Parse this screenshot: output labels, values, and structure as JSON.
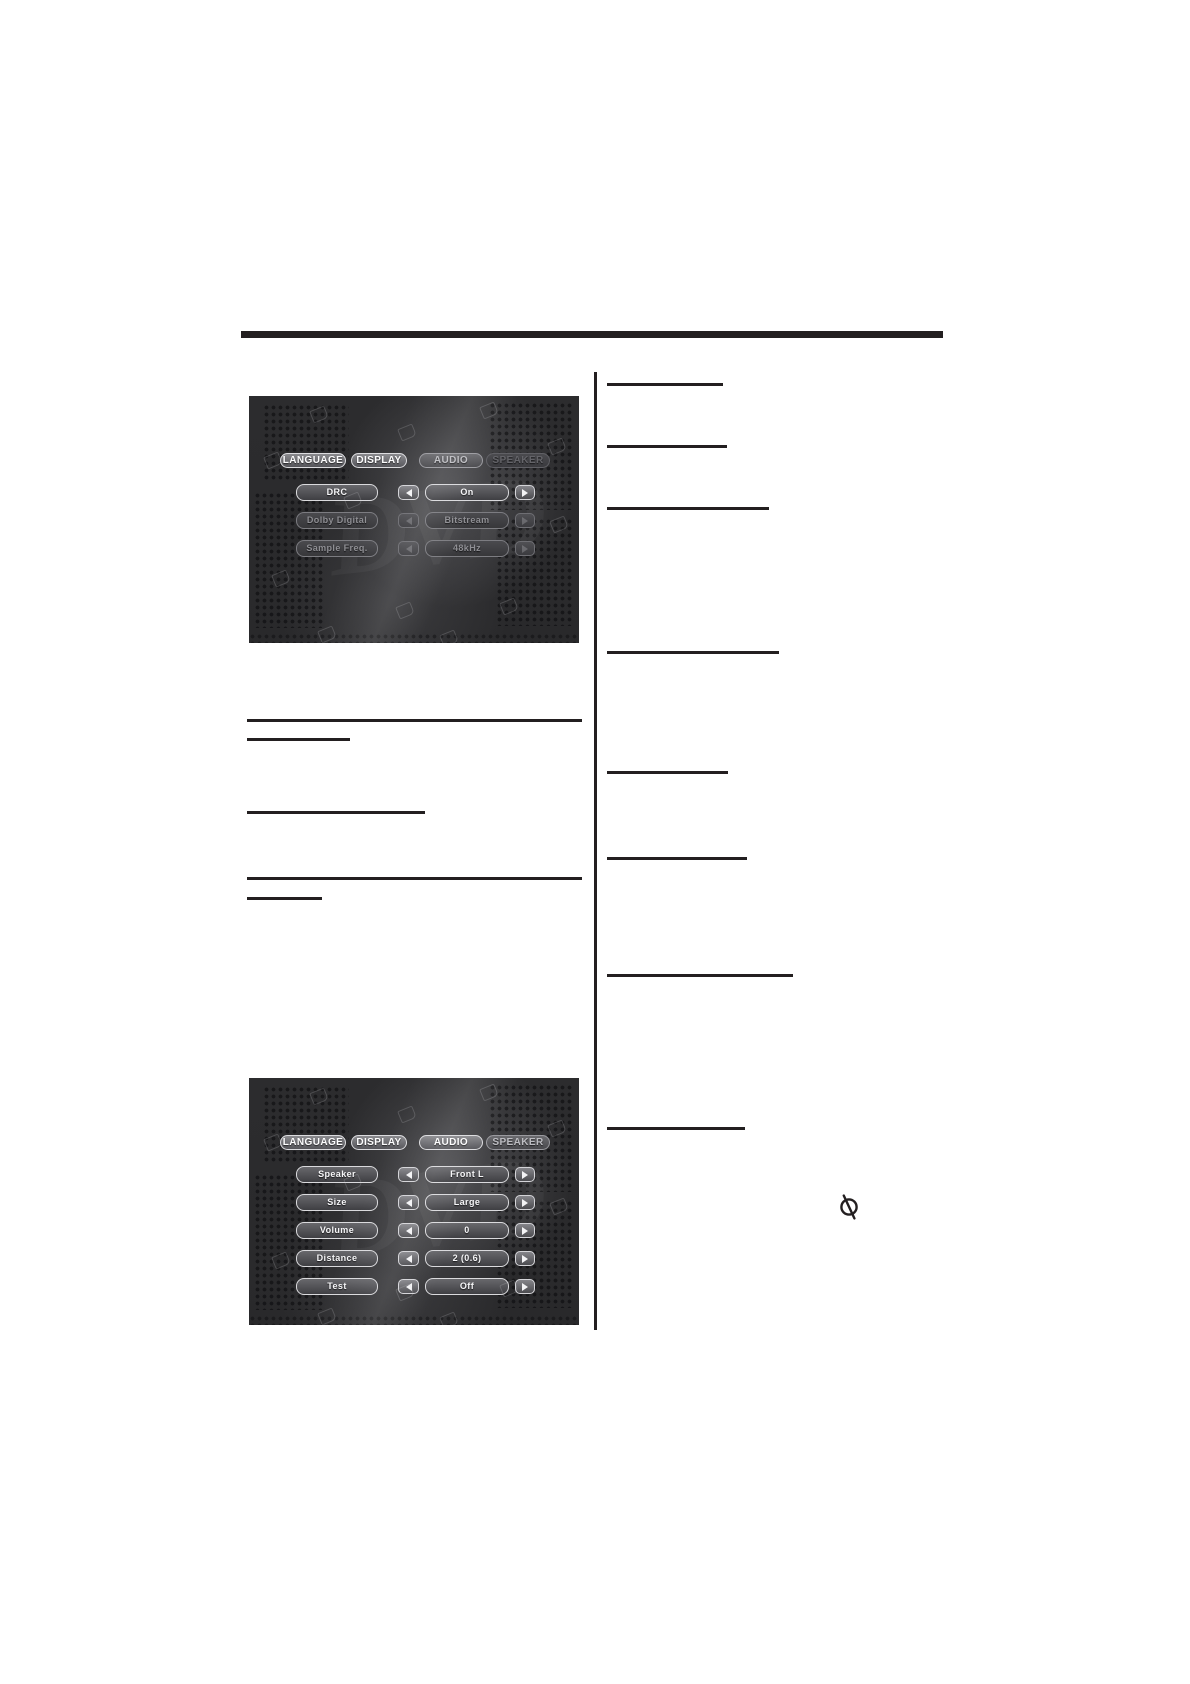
{
  "page": {
    "ink_color": "#231f20",
    "background_color": "#ffffff",
    "panel_background_color": "#2b2b2d",
    "osd_text_bright_color": "#f6f6f8",
    "osd_text_dim_color": "#8f8f94"
  },
  "osd_watermark": "DVD",
  "osd_screens": [
    {
      "name": "osd-screenshot-audio-settings",
      "tabs": [
        {
          "label": "LANGUAGE",
          "state": "bright"
        },
        {
          "label": "DISPLAY",
          "state": "bright"
        },
        {
          "label": "AUDIO",
          "state": "medium"
        },
        {
          "label": "SPEAKER",
          "state": "dim"
        }
      ],
      "rows": [
        {
          "label": "DRC",
          "value": "On",
          "state": "active"
        },
        {
          "label": "Dolby Digital",
          "value": "Bitstream",
          "state": "dim"
        },
        {
          "label": "Sample Freq.",
          "value": "48kHz",
          "state": "dim"
        }
      ]
    },
    {
      "name": "osd-screenshot-speaker-settings",
      "tabs": [
        {
          "label": "LANGUAGE",
          "state": "bright"
        },
        {
          "label": "DISPLAY",
          "state": "bright"
        },
        {
          "label": "AUDIO",
          "state": "bright"
        },
        {
          "label": "SPEAKER",
          "state": "medium"
        }
      ],
      "rows": [
        {
          "label": "Speaker",
          "value": "Front L",
          "state": "active"
        },
        {
          "label": "Size",
          "value": "Large",
          "state": "active"
        },
        {
          "label": "Volume",
          "value": "0",
          "state": "active"
        },
        {
          "label": "Distance",
          "value": "2 (0.6)",
          "state": "active"
        },
        {
          "label": "Test",
          "value": "Off",
          "state": "active"
        }
      ]
    }
  ],
  "print_marks": {
    "top_bar": {
      "name": "section-title-bar",
      "x": 241,
      "y": 331,
      "w": 702,
      "h": 7
    },
    "divider": {
      "name": "column-divider-line",
      "x": 594,
      "y": 372,
      "w": 2.5,
      "h": 958
    },
    "rules": [
      {
        "name": "left-column-rule-1",
        "x": 247,
        "y": 719,
        "w": 335,
        "h": 3
      },
      {
        "name": "left-heading-underline-1",
        "x": 247,
        "y": 738,
        "w": 103,
        "h": 2.5
      },
      {
        "name": "left-heading-underline-2",
        "x": 247,
        "y": 811,
        "w": 178,
        "h": 2.5
      },
      {
        "name": "left-column-rule-2",
        "x": 247,
        "y": 877,
        "w": 335,
        "h": 3
      },
      {
        "name": "left-heading-underline-3",
        "x": 247,
        "y": 897,
        "w": 75,
        "h": 2.5
      },
      {
        "name": "right-heading-underline-1",
        "x": 607,
        "y": 383,
        "w": 116,
        "h": 2.5
      },
      {
        "name": "right-heading-underline-2",
        "x": 607,
        "y": 445,
        "w": 120,
        "h": 2.5
      },
      {
        "name": "right-heading-underline-3",
        "x": 607,
        "y": 507,
        "w": 162,
        "h": 2.5
      },
      {
        "name": "right-heading-underline-4",
        "x": 607,
        "y": 651,
        "w": 172,
        "h": 2.5
      },
      {
        "name": "right-heading-underline-5",
        "x": 607,
        "y": 771,
        "w": 121,
        "h": 2.5
      },
      {
        "name": "right-heading-underline-6",
        "x": 607,
        "y": 857,
        "w": 140,
        "h": 2.5
      },
      {
        "name": "right-heading-underline-7",
        "x": 607,
        "y": 974,
        "w": 186,
        "h": 2.5
      },
      {
        "name": "right-heading-underline-8",
        "x": 607,
        "y": 1127,
        "w": 138,
        "h": 2.5
      }
    ],
    "prohibited_icon": {
      "name": "prohibited-icon",
      "x": 834,
      "y": 1192,
      "size": 30
    }
  }
}
